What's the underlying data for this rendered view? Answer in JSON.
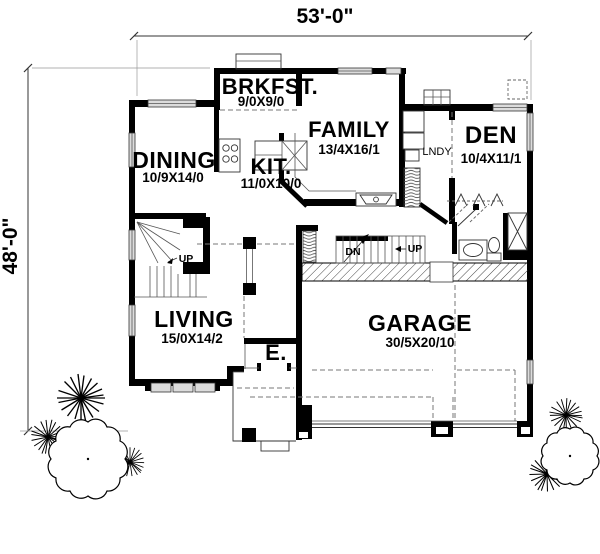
{
  "plan": {
    "width_dim": "53'-0\"",
    "height_dim": "48'-0\"",
    "rooms": {
      "brkfst": {
        "name": "BRKFST.",
        "size": "9/0X9/0"
      },
      "family": {
        "name": "FAMILY",
        "size": "13/4X16/1"
      },
      "den": {
        "name": "DEN",
        "size": "10/4X11/1"
      },
      "dining": {
        "name": "DINING",
        "size": "10/9X14/0"
      },
      "kitchen": {
        "name": "KIT.",
        "size": "11/0X10/0"
      },
      "living": {
        "name": "LIVING",
        "size": "15/0X14/2"
      },
      "garage": {
        "name": "GARAGE",
        "size": "30/5X20/10"
      },
      "entry": {
        "name": "E."
      },
      "laundry": {
        "name": "LNDY"
      }
    },
    "stairs": {
      "up_left": "UP",
      "down": "DN",
      "up_right": "UP"
    }
  },
  "colors": {
    "ink": "#000000",
    "window_fill": "#dcdcdc",
    "dash": "#777777"
  }
}
